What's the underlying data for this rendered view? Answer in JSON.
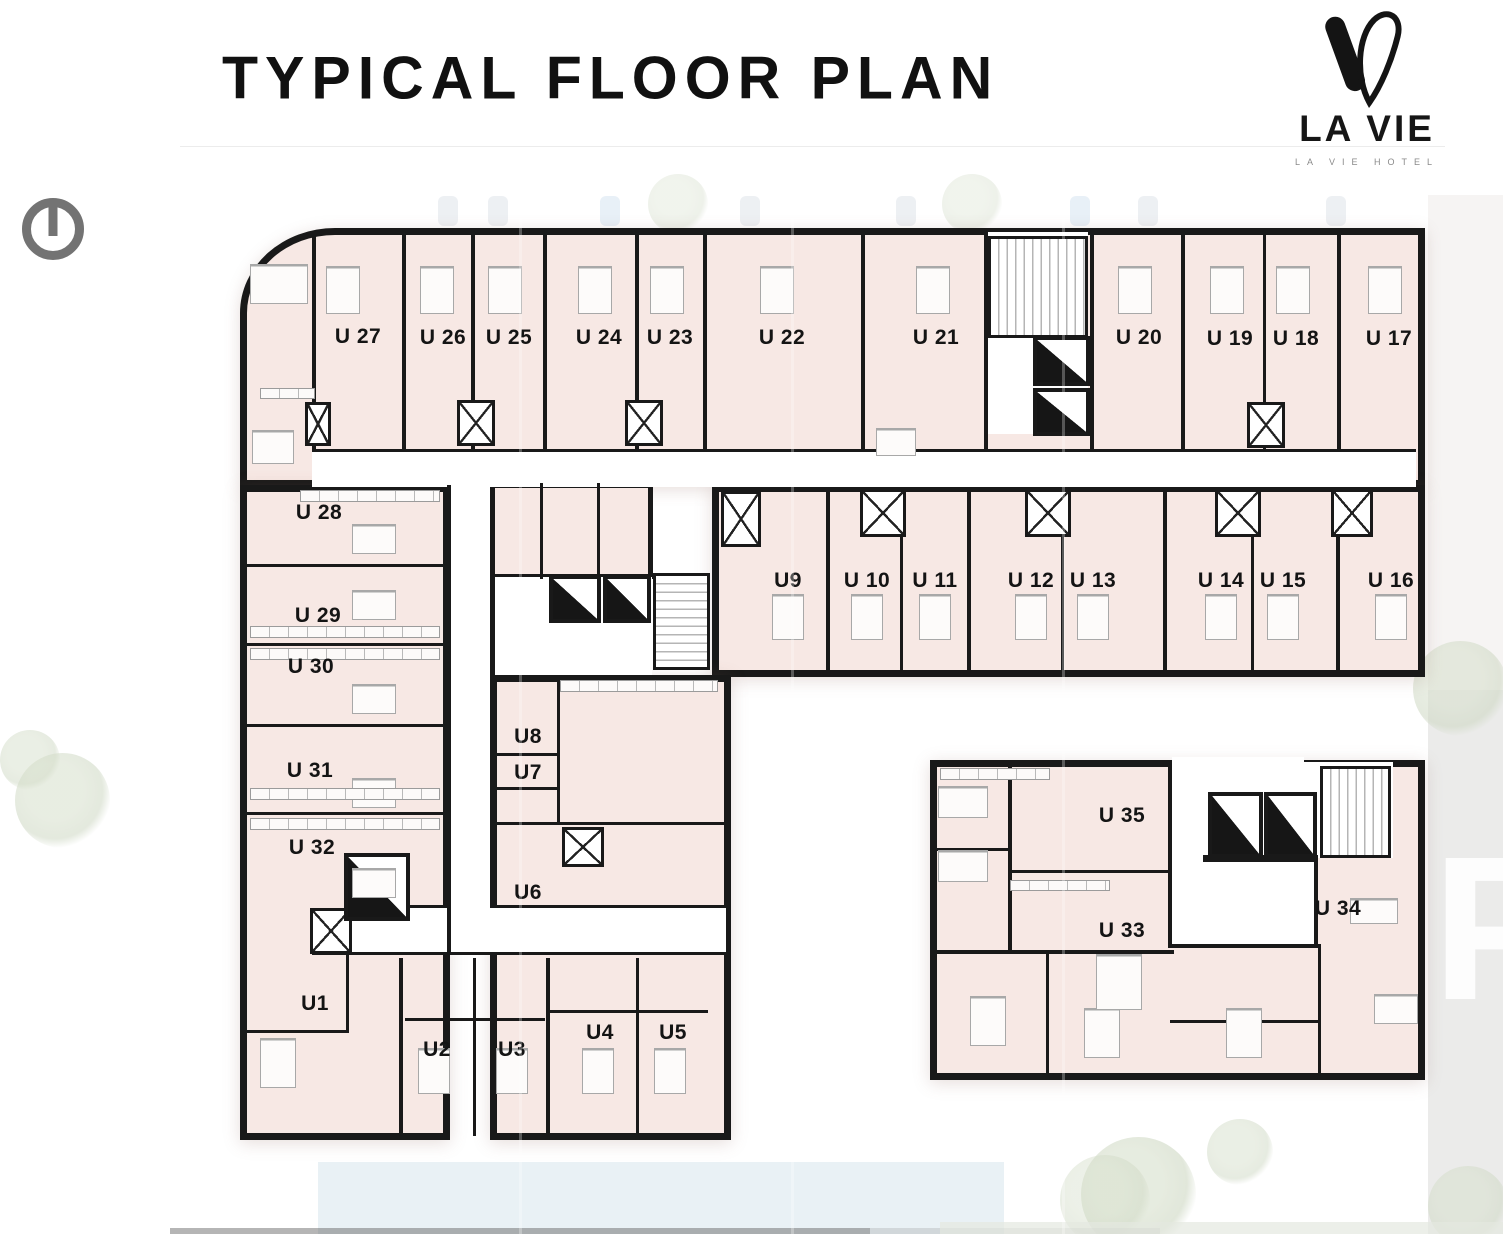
{
  "header": {
    "title": "TYPICAL FLOOR PLAN"
  },
  "logo": {
    "name": "LA VIE",
    "tagline": "LA VIE HOTEL"
  },
  "watermark": "P",
  "icons": {
    "north_indicator": "north-indicator-icon",
    "logo_mark": "la-vie-v-mark"
  },
  "colors": {
    "room": "#f7e8e4",
    "wall": "#191919",
    "pool": "#e9f1f5",
    "tree": "#cdd7c2",
    "panel": "#ebebea",
    "north": "#737373"
  },
  "plan": {
    "units": [
      {
        "label": "U1",
        "x": 315,
        "y": 1004
      },
      {
        "label": "U2",
        "x": 437,
        "y": 1050
      },
      {
        "label": "U3",
        "x": 512,
        "y": 1050
      },
      {
        "label": "U4",
        "x": 600,
        "y": 1033
      },
      {
        "label": "U5",
        "x": 673,
        "y": 1033
      },
      {
        "label": "U6",
        "x": 528,
        "y": 893
      },
      {
        "label": "U7",
        "x": 528,
        "y": 773
      },
      {
        "label": "U8",
        "x": 528,
        "y": 737
      },
      {
        "label": "U9",
        "x": 788,
        "y": 581
      },
      {
        "label": "U 10",
        "x": 867,
        "y": 581
      },
      {
        "label": "U 11",
        "x": 935,
        "y": 581
      },
      {
        "label": "U 12",
        "x": 1031,
        "y": 581
      },
      {
        "label": "U 13",
        "x": 1093,
        "y": 581
      },
      {
        "label": "U 14",
        "x": 1221,
        "y": 581
      },
      {
        "label": "U 15",
        "x": 1283,
        "y": 581
      },
      {
        "label": "U 16",
        "x": 1391,
        "y": 581
      },
      {
        "label": "U 17",
        "x": 1389,
        "y": 339
      },
      {
        "label": "U 18",
        "x": 1296,
        "y": 339
      },
      {
        "label": "U 19",
        "x": 1230,
        "y": 339
      },
      {
        "label": "U 20",
        "x": 1139,
        "y": 338
      },
      {
        "label": "U 21",
        "x": 936,
        "y": 338
      },
      {
        "label": "U 22",
        "x": 782,
        "y": 338
      },
      {
        "label": "U 23",
        "x": 670,
        "y": 338
      },
      {
        "label": "U 24",
        "x": 599,
        "y": 338
      },
      {
        "label": "U 25",
        "x": 509,
        "y": 338
      },
      {
        "label": "U 26",
        "x": 443,
        "y": 338
      },
      {
        "label": "U 27",
        "x": 358,
        "y": 337
      },
      {
        "label": "U 28",
        "x": 319,
        "y": 513
      },
      {
        "label": "U 29",
        "x": 318,
        "y": 616
      },
      {
        "label": "U 30",
        "x": 311,
        "y": 667
      },
      {
        "label": "U 31",
        "x": 310,
        "y": 771
      },
      {
        "label": "U 32",
        "x": 312,
        "y": 848
      },
      {
        "label": "U 33",
        "x": 1122,
        "y": 931
      },
      {
        "label": "U 34",
        "x": 1338,
        "y": 909
      },
      {
        "label": "U 35",
        "x": 1122,
        "y": 816
      }
    ]
  }
}
